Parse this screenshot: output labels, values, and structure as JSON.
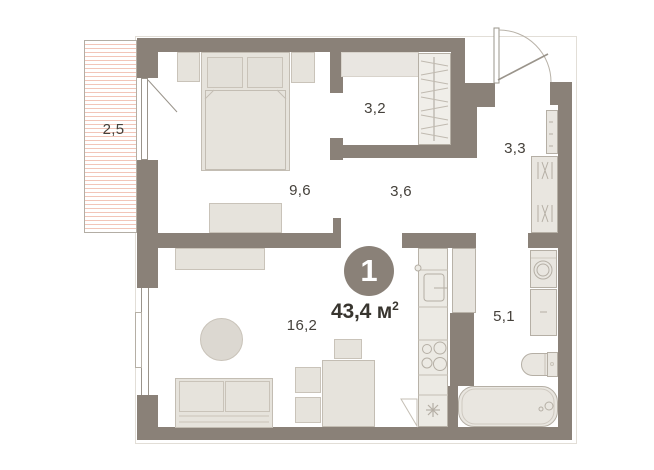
{
  "plan": {
    "badge": "1",
    "area_value": "43,4",
    "area_unit": "м",
    "area_exponent": "2",
    "rooms": [
      {
        "name": "balcony",
        "area": "2,5"
      },
      {
        "name": "bedroom",
        "area": "9,6"
      },
      {
        "name": "wardrobe",
        "area": "3,2"
      },
      {
        "name": "hallway",
        "area": "3,6"
      },
      {
        "name": "entry-hall",
        "area": "3,3"
      },
      {
        "name": "living-kitchen",
        "area": "16,2"
      },
      {
        "name": "bathroom",
        "area": "5,1"
      }
    ],
    "colors": {
      "wall": "#8a8178",
      "furniture_fill": "#e9e6e0",
      "furniture_outline": "#b5afa5",
      "balcony_hatch": "#f2c5b8",
      "label_text": "#45413b",
      "badge_background": "#8a8178",
      "badge_text": "#ffffff"
    }
  }
}
